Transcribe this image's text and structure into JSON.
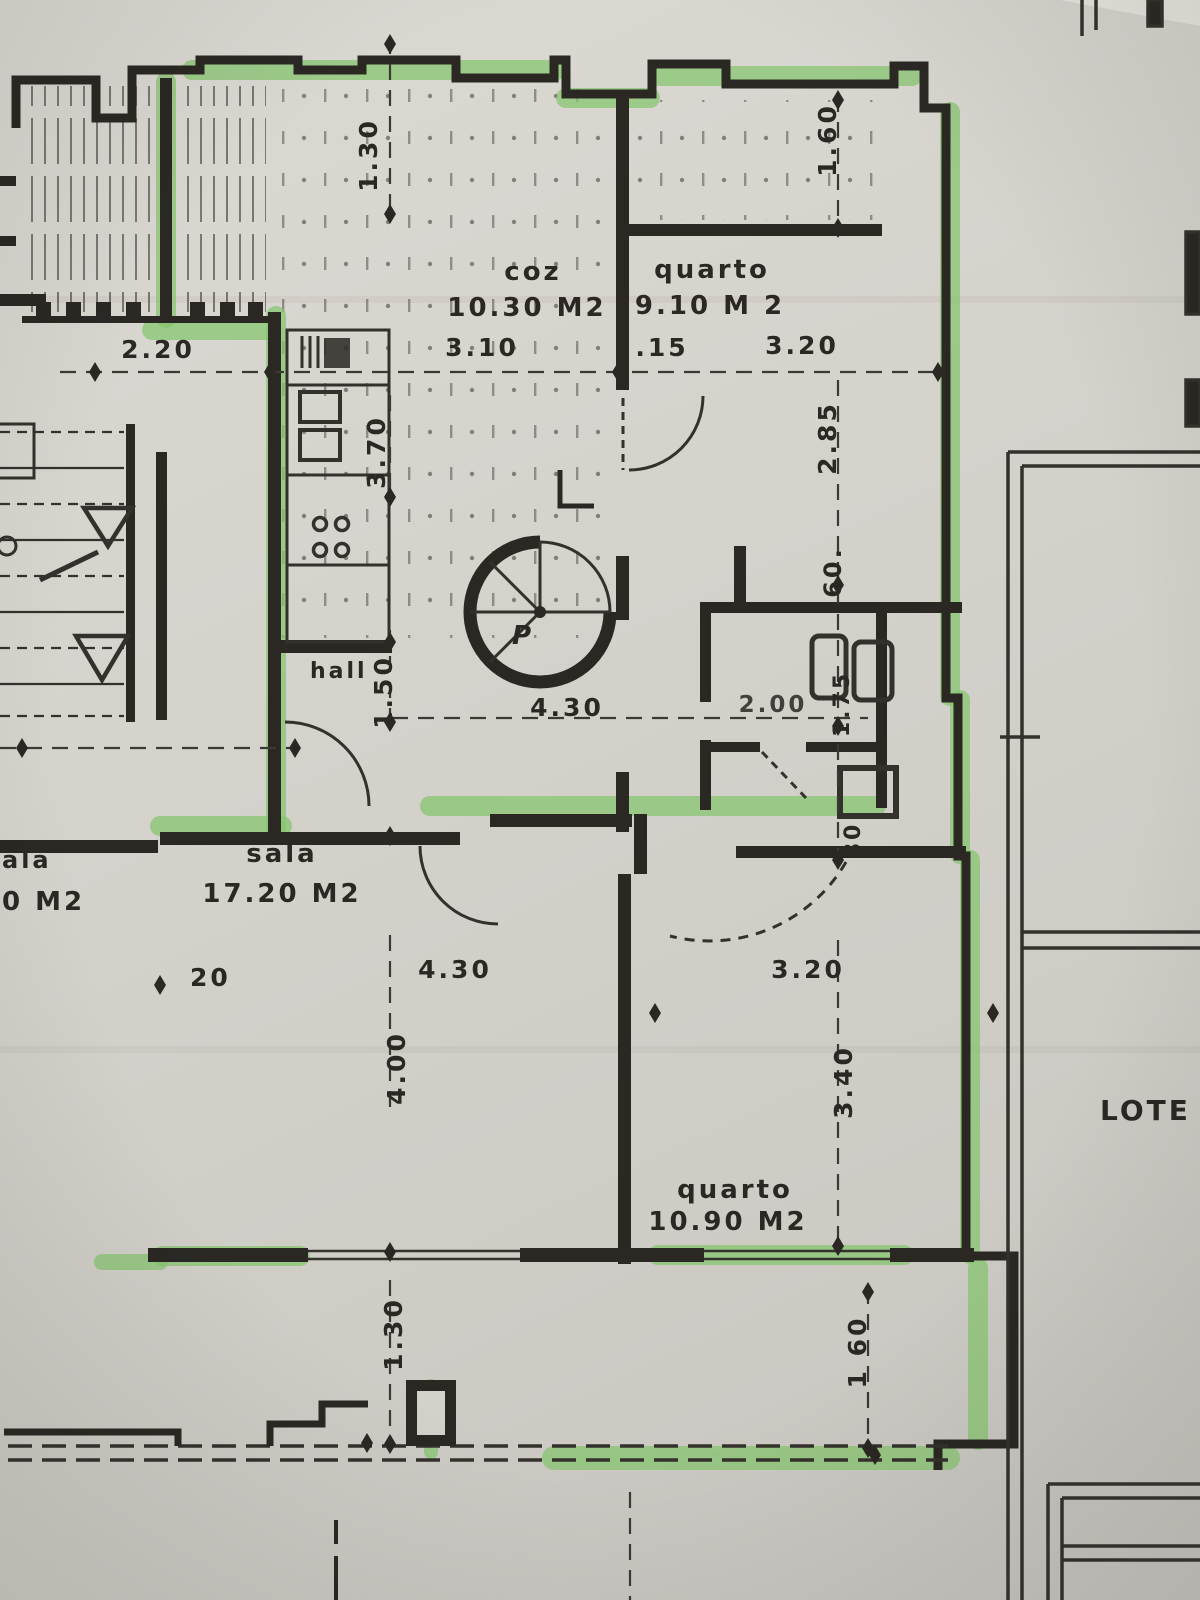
{
  "plan": {
    "rooms": {
      "kitchen": {
        "name": "coz",
        "area": "10.30 M2"
      },
      "bedroom_top": {
        "name": "quarto",
        "area": "9.10 M 2"
      },
      "living": {
        "name": "sala",
        "area": "17.20 M2"
      },
      "bedroom_bottom": {
        "name": "quarto",
        "area": "10.90 M2"
      },
      "hall": {
        "name": "hall"
      },
      "neighbor_living": {
        "name": "ala",
        "area": "0 M2"
      }
    },
    "annotations": {
      "lot": "LOTE",
      "stair_direction": "P"
    },
    "dims": {
      "terrace_top": "1.30",
      "terrace_top_right": "1.60",
      "w220": "2.20",
      "w310": "3.10",
      "w015": ".15",
      "w320_top": "3.20",
      "h370": "3.70",
      "h285": "2.85",
      "h60": "60.",
      "h150": "1.50",
      "w430_hall": "4.30",
      "w200": "2.00",
      "h175": "1.75",
      "h80": "80",
      "w20": "20",
      "w430_sala": "4.30",
      "h400": "4.00",
      "w320_bed": "3.20",
      "h340": "3.40",
      "h130_bottom": "1.30",
      "h160_bottom": "1 60"
    },
    "colors": {
      "ink": "#2b2824",
      "highlighter": "#84c56c",
      "paper": "#d6d3cd"
    }
  }
}
